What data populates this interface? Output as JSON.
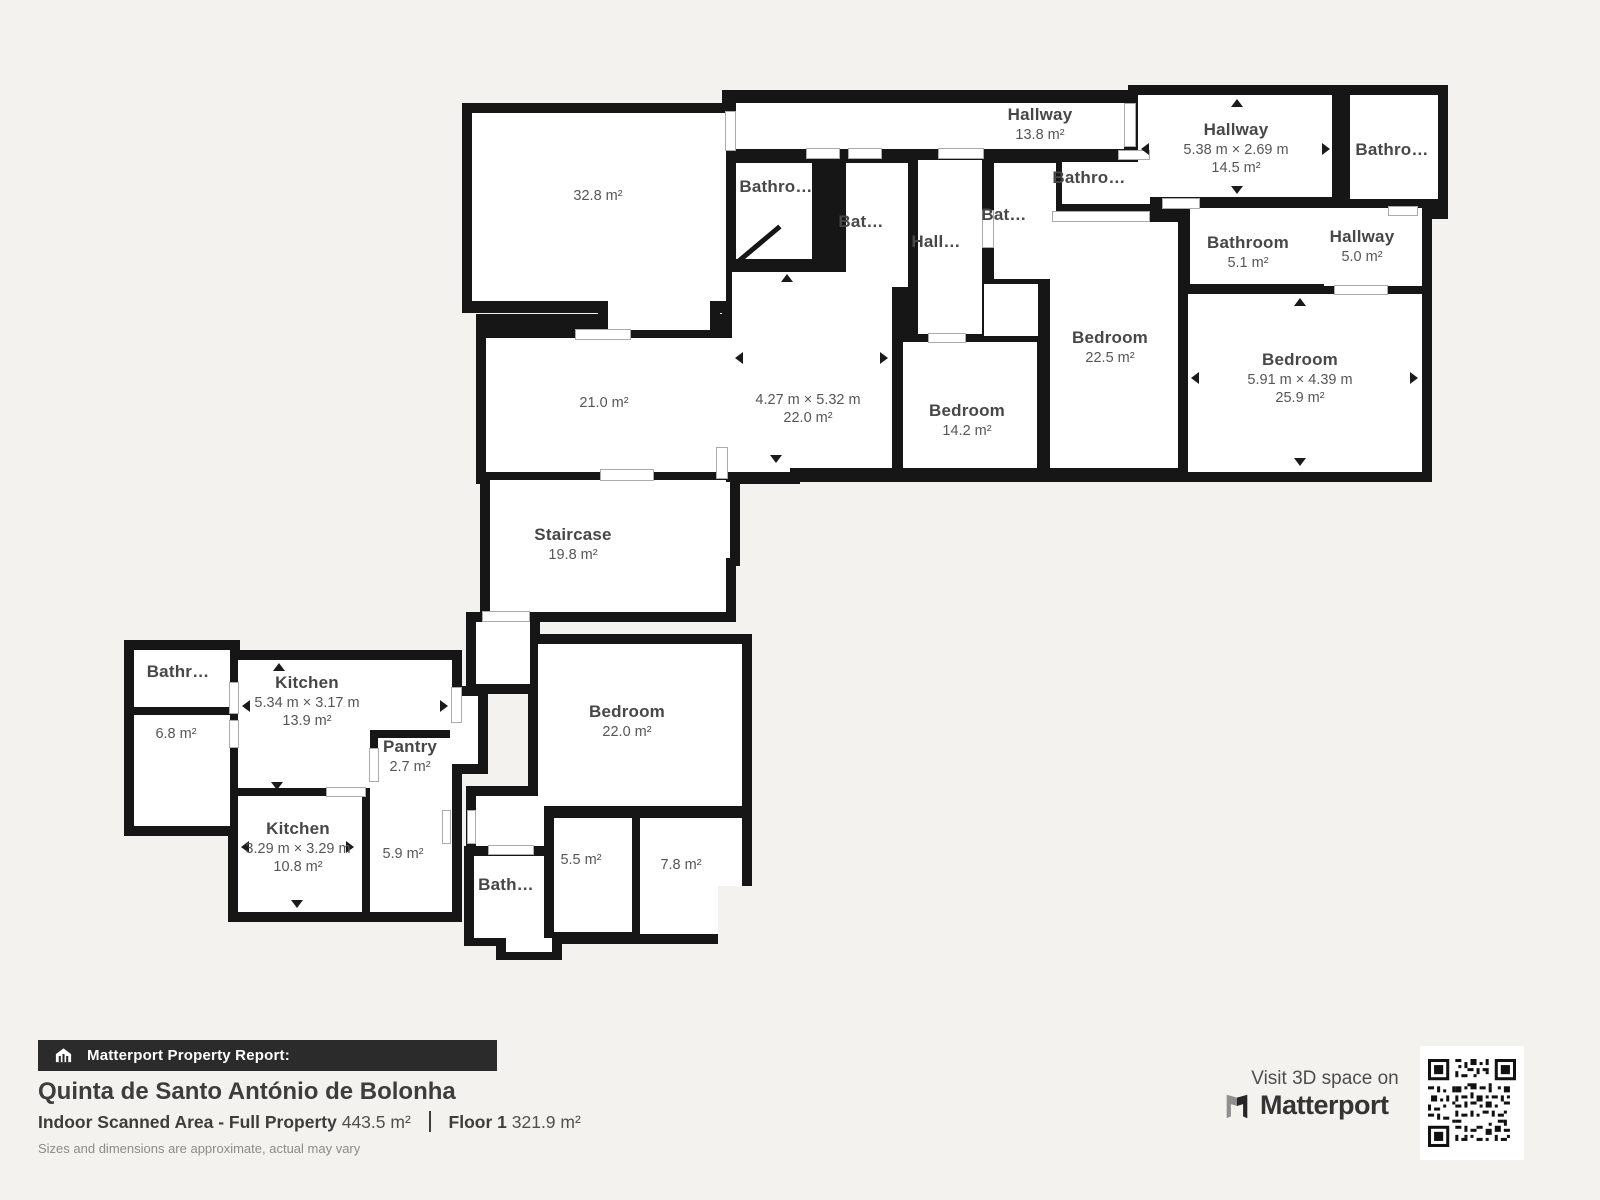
{
  "colors": {
    "background": "#f4f2ef",
    "wall": "#161616",
    "room": "#ffffff",
    "label": "#565656",
    "footer_bar": "#2b2b2b"
  },
  "rooms": {
    "hallway_top": {
      "name": "Hallway",
      "area": "13.8 m²"
    },
    "hallway_right": {
      "name": "Hallway",
      "dims": "5.38 m × 2.69 m",
      "area": "14.5 m²"
    },
    "bathroom_top_right": {
      "name": "Bathro…"
    },
    "bathroom_5_1": {
      "name": "Bathroom",
      "area": "5.1 m²"
    },
    "hallway_5_0": {
      "name": "Hallway",
      "area": "5.0 m²"
    },
    "bedroom_25_9": {
      "name": "Bedroom",
      "dims": "5.91 m × 4.39 m",
      "area": "25.9 m²"
    },
    "bedroom_22_5": {
      "name": "Bedroom",
      "area": "22.5 m²"
    },
    "bathroom_a": {
      "name": "Bathro…"
    },
    "bathroom_b": {
      "name": "Bat…"
    },
    "hallway_small": {
      "name": "Hall…"
    },
    "bathroom_c": {
      "name": "Bat…"
    },
    "bathroom_d": {
      "name": "Bathro…"
    },
    "living_32_8": {
      "area": "32.8 m²"
    },
    "room_21_0": {
      "area": "21.0 m²"
    },
    "staircase": {
      "name": "Staircase",
      "area": "19.8 m²"
    },
    "bedroom_22_0_main": {
      "dims": "4.27 m × 5.32 m",
      "area": "22.0 m²"
    },
    "bedroom_14_2": {
      "name": "Bedroom",
      "area": "14.2 m²"
    },
    "bathroom_left": {
      "name": "Bathr…"
    },
    "room_6_8": {
      "area": "6.8 m²"
    },
    "kitchen_13_9": {
      "name": "Kitchen",
      "dims": "5.34 m × 3.17 m",
      "area": "13.9 m²"
    },
    "pantry": {
      "name": "Pantry",
      "area": "2.7 m²"
    },
    "kitchen_10_8": {
      "name": "Kitchen",
      "dims": "3.29 m × 3.29 m",
      "area": "10.8 m²"
    },
    "room_5_9": {
      "area": "5.9 m²"
    },
    "bathroom_bottom": {
      "name": "Bath…"
    },
    "room_5_5": {
      "area": "5.5 m²"
    },
    "room_7_8": {
      "area": "7.8 m²"
    },
    "bedroom_22_0_lower": {
      "name": "Bedroom",
      "area": "22.0 m²"
    }
  },
  "footer": {
    "report_label": "Matterport Property Report:",
    "property_name": "Quinta de Santo António de Bolonha",
    "scanned_area_label": "Indoor Scanned Area - Full Property",
    "scanned_area_value": "443.5 m²",
    "floor_label": "Floor 1",
    "floor_value": "321.9 m²",
    "disclaimer": "Sizes and dimensions are approximate, actual may vary",
    "visit_label": "Visit 3D space on",
    "brand": "Matterport"
  }
}
